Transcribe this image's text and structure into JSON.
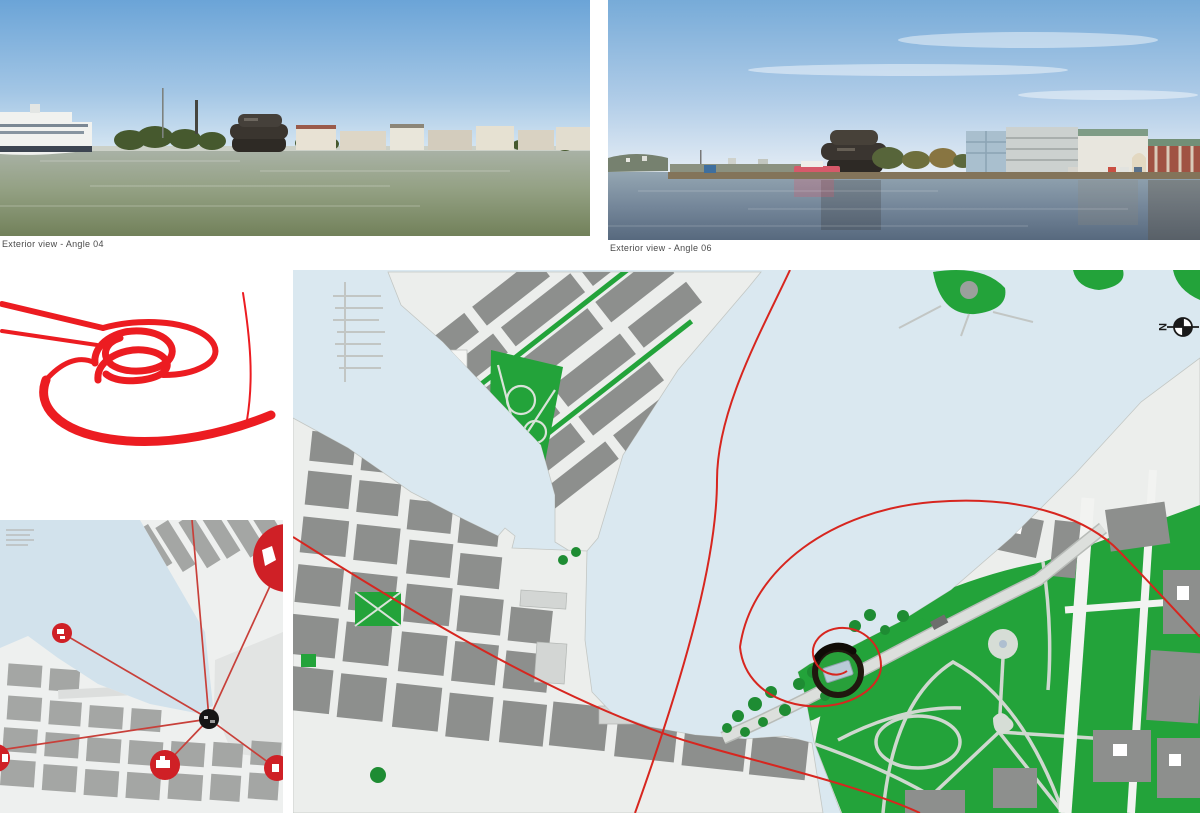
{
  "captions": {
    "photo_left": "Exterior view - Angle 04",
    "photo_right": "Exterior view - Angle 06"
  },
  "large_map": {
    "north_label": "N"
  },
  "colors": {
    "accent_red": "#d7261f",
    "ribbon_red": "#ec1c21",
    "marker_red": "#cf2026",
    "park_green": "#23a33a",
    "tree_green": "#1e8c33",
    "water_blue": "#dae8f0",
    "small_water_blue": "#d2e2ec",
    "building_gray": "#8d8f8d",
    "land_gray": "#eceeec",
    "site_ring_black": "#20180f",
    "caption_gray": "#4a4a4a"
  }
}
